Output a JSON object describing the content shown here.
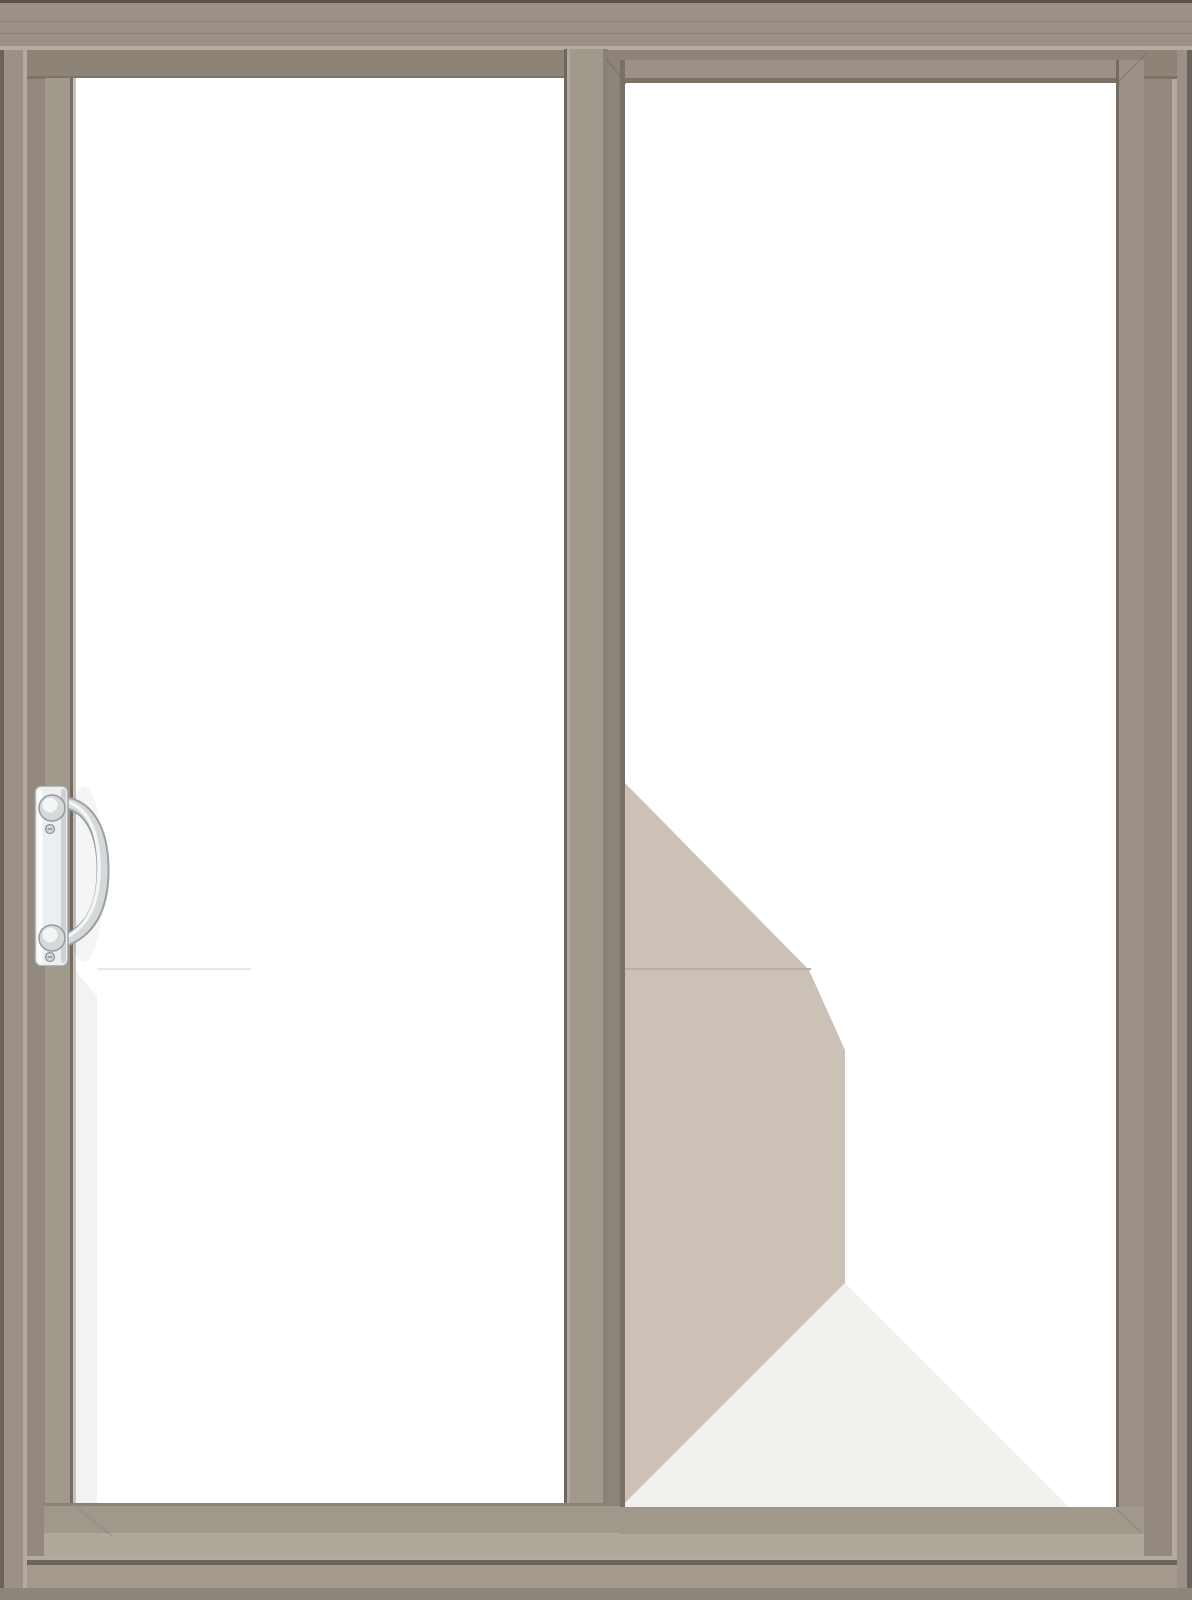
{
  "scene": {
    "type": "product-render",
    "subject": "Two-panel gliding patio door, closed, front view",
    "frame_finish": "taupe / terratone clad frame",
    "panels": [
      {
        "id": "left",
        "role": "operable gliding panel",
        "depth": "foreground",
        "glazing": "clear single-lite glass",
        "hardware": "vertical satin-chrome pull handle near left stile"
      },
      {
        "id": "right",
        "role": "fixed panel",
        "depth": "recessed behind gliding panel",
        "glazing": "clear single-lite glass showing interior reflection"
      }
    ],
    "hardware": {
      "handle": "satin-chrome escutcheon plate with bowed pull grip, top and bottom knuckles, two screws"
    },
    "reflections": {
      "right_glass": "large taupe wall reflection with 45-degree top edge, horizontal seam, vertical edge and a pale floor triangle at bottom",
      "left_glass": "faint pale vertical band along lower left stile with subtle seam line"
    }
  },
  "colors": {
    "frame_face": "#9b9187",
    "frame_edge_dark": "#6b635b",
    "frame_light_line": "#b5ac9f",
    "jamb_shadow": "#93897e",
    "head_inner": "#8d8377",
    "head_inner_edge": "#7c7367",
    "top_edge": "#5a524b",
    "stile_face": "#a2998d",
    "stile_dark": "#746c62",
    "stile_highlight": "#c9c2b8",
    "meeting_edge": "#8a8177",
    "meeting_edge_shadow": "#6f675f",
    "fixed_shadow": "#8e857a",
    "fixed_groove": "#7a7268",
    "glass": "#ffffff",
    "reflection_dark": "#cbc1b7",
    "reflection_seam": "#b9afa4",
    "reflection_light": "#f1f0ed",
    "reflection_faint": "#f3f2f0",
    "rail_face": "#a1988c",
    "rail_bevel": "#b1a89c",
    "rail_edge": "#8c8378",
    "sill_ridge": "#b4ab9f",
    "sill_groove": "#6e665e",
    "sill_face": "#a39a8d",
    "base_strip": "#8d857a",
    "chrome_outline": "#9aa0a4",
    "chrome_mid": "#d6d9da",
    "chrome_light": "#f4f5f6",
    "chrome_plate": "#eceeef"
  }
}
